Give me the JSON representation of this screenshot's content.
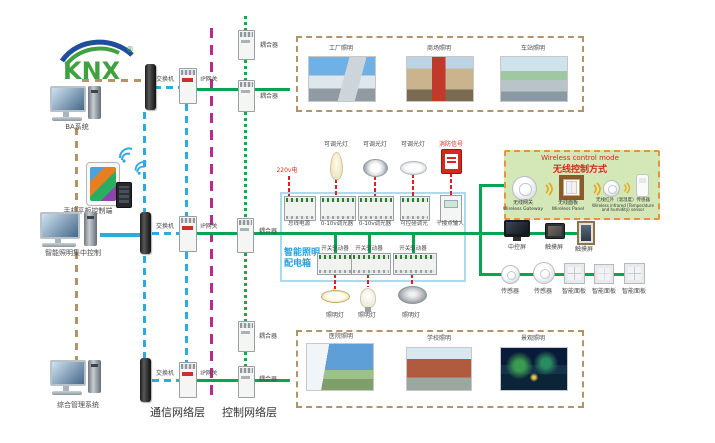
{
  "logo": {
    "text": "KNX",
    "registered": "®"
  },
  "colors": {
    "bus_green": "#00a650",
    "ethernet_blue": "#2eaae1",
    "backbone_magenta": "#b82b8e",
    "power_red": "#e51c24",
    "dashed_tan": "#b29468",
    "panel_border_blue": "#aadcee",
    "wireless_bg_green": "#d3e8b6",
    "wireless_border_orange": "#e8923a"
  },
  "left_column": {
    "pc_ba": {
      "label": "BA系统"
    },
    "mobile": {
      "label": "手机平板控制端"
    },
    "pc_lighting": {
      "label": "智能照明集中控制"
    },
    "pc_mgmt": {
      "label": "综合管理系统"
    }
  },
  "network": {
    "switches": [
      "交换机",
      "交换机",
      "交换机"
    ],
    "gateways": [
      "IP网关",
      "IP网关",
      "IP网关"
    ],
    "couplers": [
      "耦合器",
      "耦合器",
      "耦合器",
      "耦合器",
      "耦合器"
    ],
    "layers": {
      "comm": "通信网络层",
      "ctrl": "控制网络层"
    }
  },
  "top_gallery": {
    "items": [
      {
        "label": "工厂照明"
      },
      {
        "label": "商场照明"
      },
      {
        "label": "车站照明"
      }
    ]
  },
  "bottom_gallery": {
    "items": [
      {
        "label": "医院照明"
      },
      {
        "label": "学校照明"
      },
      {
        "label": "景观照明"
      }
    ]
  },
  "panel": {
    "title_1": "智能照明",
    "title_2": "配电箱",
    "power_label": "220v电",
    "top_loads": [
      "可调光灯",
      "可调光灯",
      "可调光灯",
      "消防信号"
    ],
    "row1_devices": [
      "总线电源",
      "0-10v调光器",
      "0-10v调光器",
      "可控硅调光",
      "干接点输入"
    ],
    "row2_devices": [
      "开关驱动器",
      "开关驱动器",
      "开关驱动器"
    ],
    "bottom_loads": [
      "照明灯",
      "照明灯",
      "照明灯"
    ]
  },
  "wireless_box": {
    "title_en": "Wireless control mode",
    "title_cn": "无线控制方式",
    "devices": [
      {
        "cn": "无线网关",
        "en": "Wireless Gateway"
      },
      {
        "cn": "无线面板",
        "en": "Wireless Panel"
      },
      {
        "cn": "无线红外（温湿度）传感器",
        "en": "Wireless infrared (Temperature and humidity) sensor"
      }
    ]
  },
  "control_devices": {
    "screen_row": [
      "中控屏",
      "触摸屏",
      "触摸屏"
    ],
    "sensor_row": [
      "传感器",
      "传感器",
      "智能面板",
      "智能面板",
      "智能面板"
    ]
  }
}
